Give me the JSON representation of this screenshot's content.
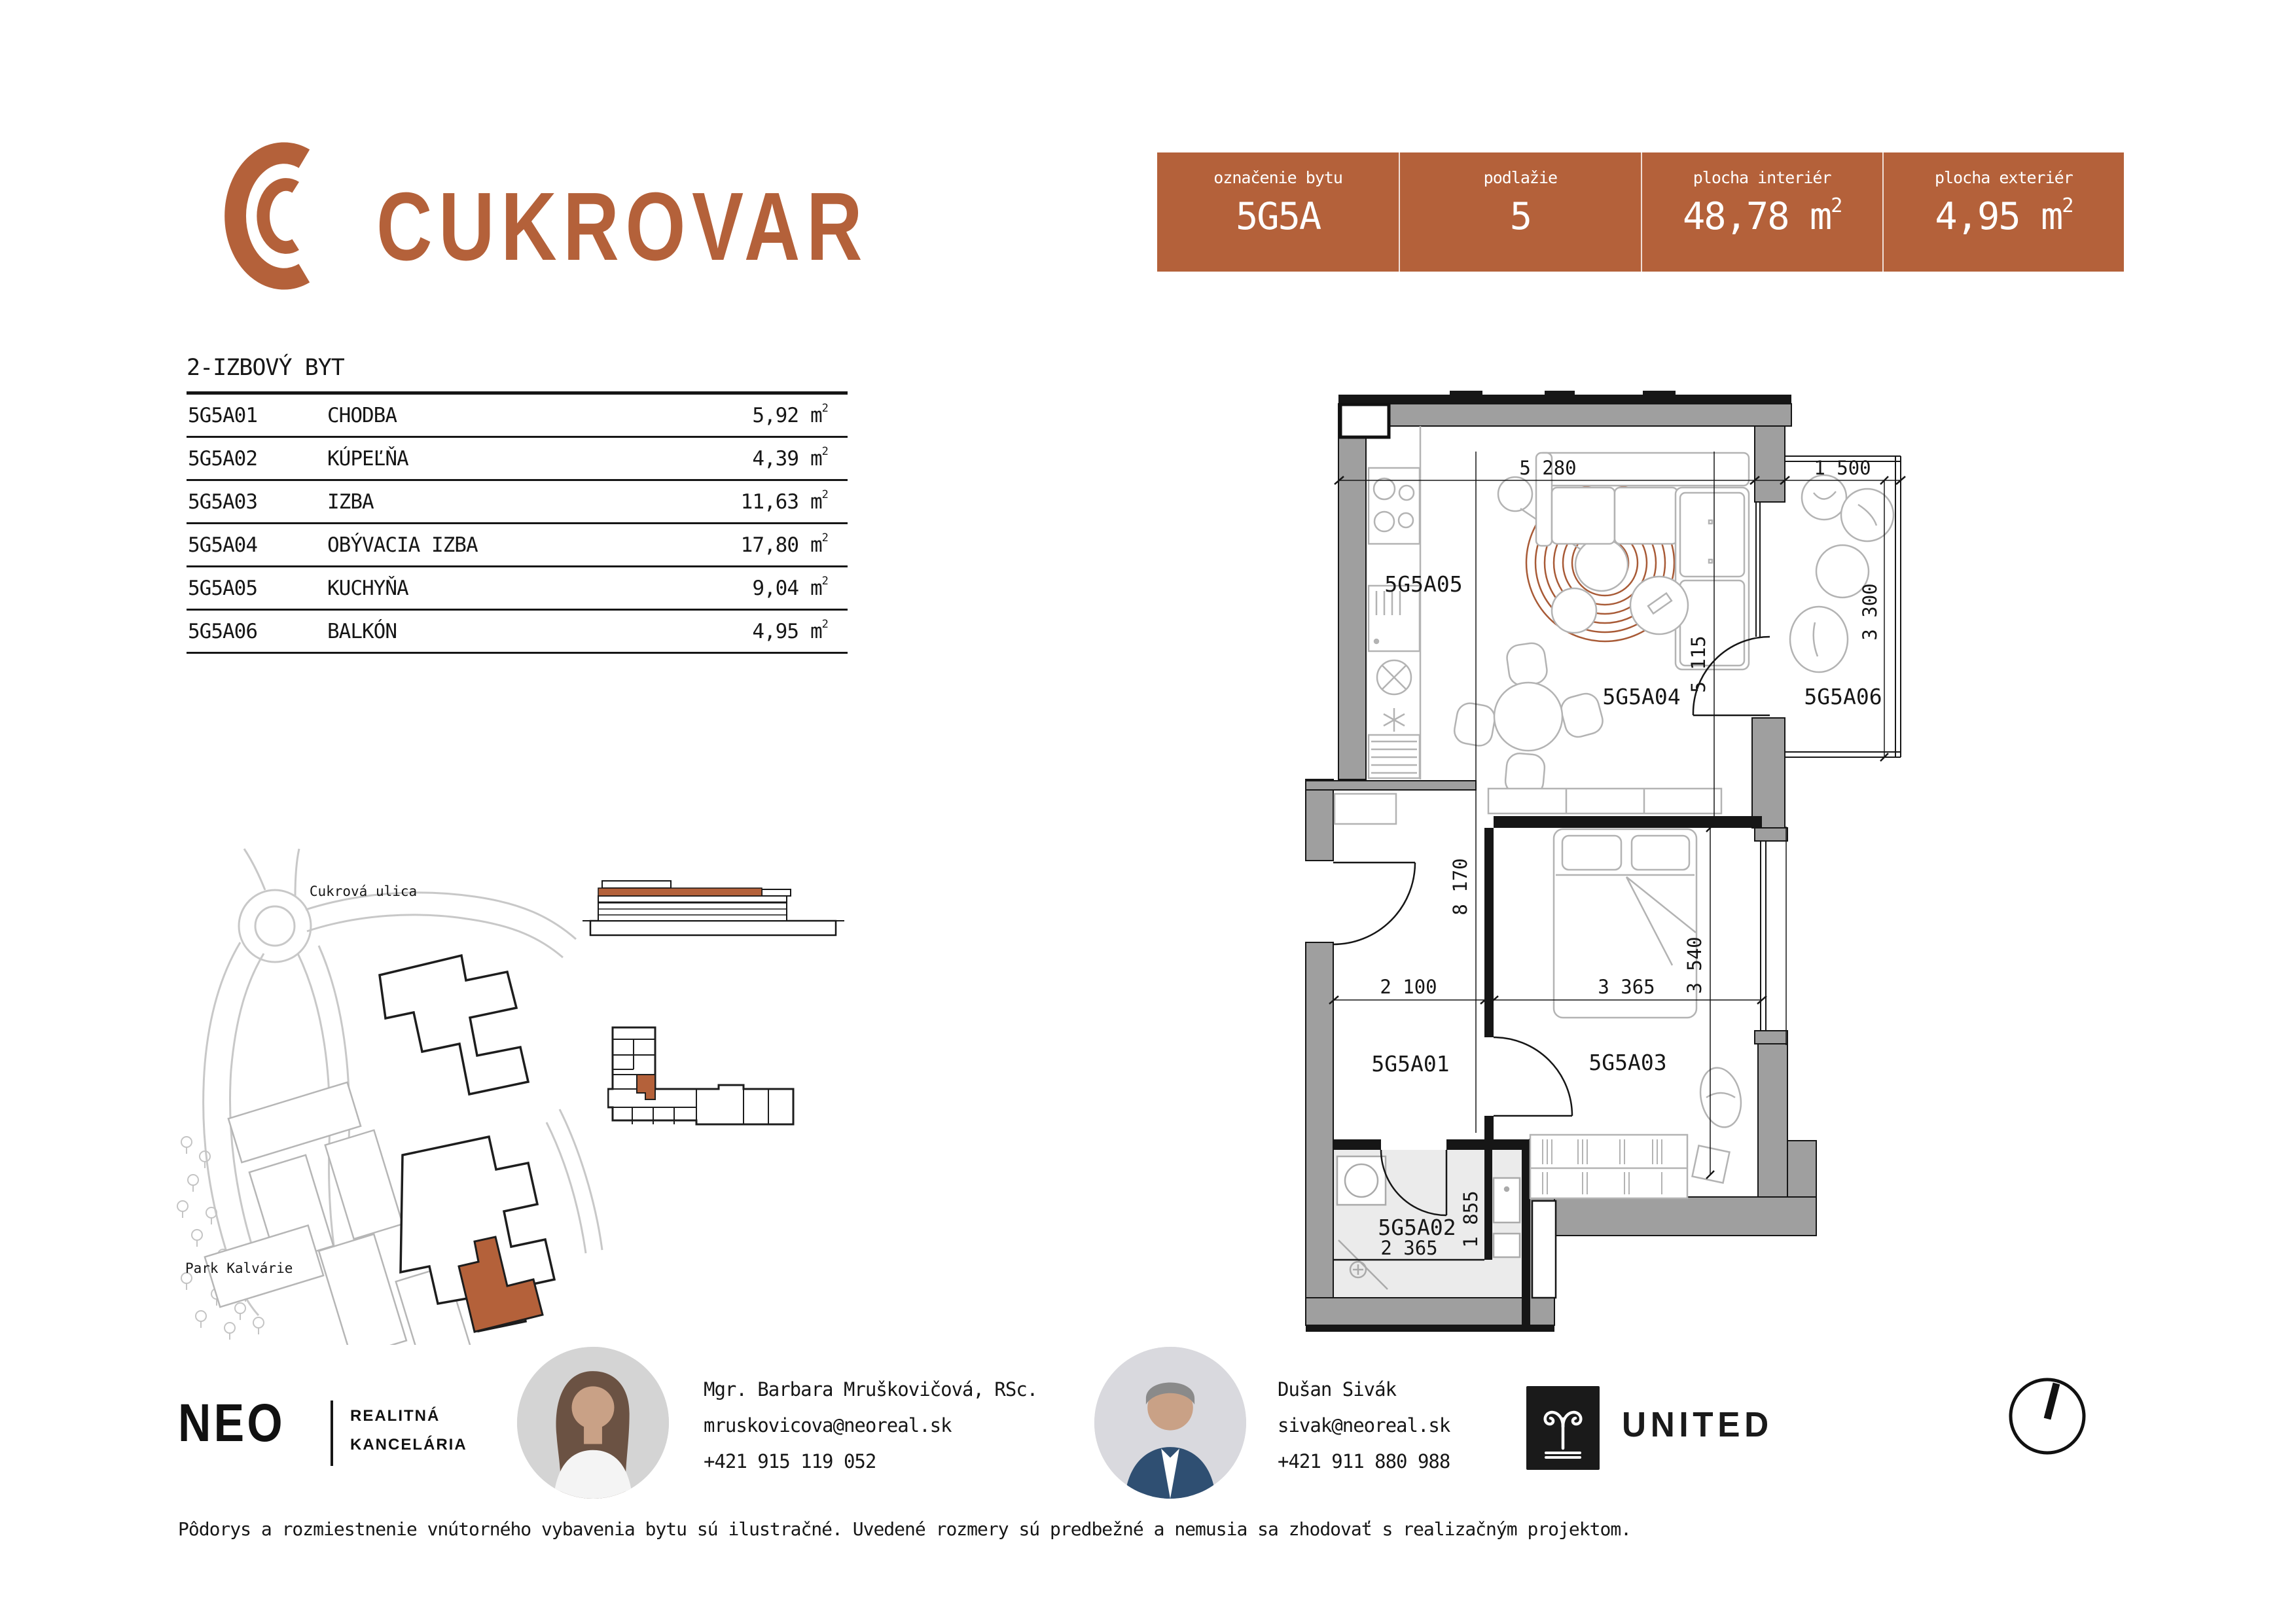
{
  "brand": {
    "title": "CUKROVAR",
    "accent": "#b4613a"
  },
  "summary": {
    "cells": [
      {
        "label": "označenie bytu",
        "value": "5G5A",
        "unit": "",
        "sup": ""
      },
      {
        "label": "podlažie",
        "value": "5",
        "unit": "",
        "sup": ""
      },
      {
        "label": "plocha interiér",
        "value": "48,78",
        "unit": "m",
        "sup": "2"
      },
      {
        "label": "plocha exteriér",
        "value": "4,95",
        "unit": "m",
        "sup": "2"
      }
    ]
  },
  "room_table": {
    "title": "2-IZBOVÝ BYT",
    "unit": "m",
    "sup": "2",
    "rows": [
      {
        "code": "5G5A01",
        "name": "CHODBA",
        "area": "5,92"
      },
      {
        "code": "5G5A02",
        "name": "KÚPEĽŇA",
        "area": "4,39"
      },
      {
        "code": "5G5A03",
        "name": "IZBA",
        "area": "11,63"
      },
      {
        "code": "5G5A04",
        "name": "OBÝVACIA IZBA",
        "area": "17,80"
      },
      {
        "code": "5G5A05",
        "name": "KUCHYŇA",
        "area": "9,04"
      },
      {
        "code": "5G5A06",
        "name": "BALKÓN",
        "area": "4,95"
      }
    ]
  },
  "plan": {
    "rooms": {
      "hall": "5G5A01",
      "bath": "5G5A02",
      "bedroom": "5G5A03",
      "living": "5G5A04",
      "kitchen": "5G5A05",
      "balcony": "5G5A06"
    },
    "dims": {
      "top": "5 280",
      "balcony_top": "1 500",
      "balcony_side": "3 300",
      "living_side": "5 115",
      "interior_height": "8 170",
      "hall_width": "2 100",
      "bedroom_width": "3 365",
      "bedroom_height": "3 540",
      "bath_height": "1 855",
      "bath_width": "2 365"
    }
  },
  "site": {
    "street": "Cukrová ulica",
    "park": "Park Kalvárie"
  },
  "contacts": {
    "agency": {
      "name": "NEO",
      "tagline1": "REALITNÁ",
      "tagline2": "KANCELÁRIA"
    },
    "agents": [
      {
        "name": "Mgr. Barbara Mruškovičová, RSc.",
        "email": "mruskovicova@neoreal.sk",
        "phone": "+421 915 119 052"
      },
      {
        "name": "Dušan Sivák",
        "email": "sivak@neoreal.sk",
        "phone": "+421 911 880 988"
      }
    ],
    "partner": {
      "name": "UNITED"
    }
  },
  "footer": {
    "disclaimer": "Pôdorys a rozmiestnenie vnútorného vybavenia bytu sú ilustračné. Uvedené rozmery sú predbežné a nemusia sa zhodovať s realizačným projektom."
  }
}
